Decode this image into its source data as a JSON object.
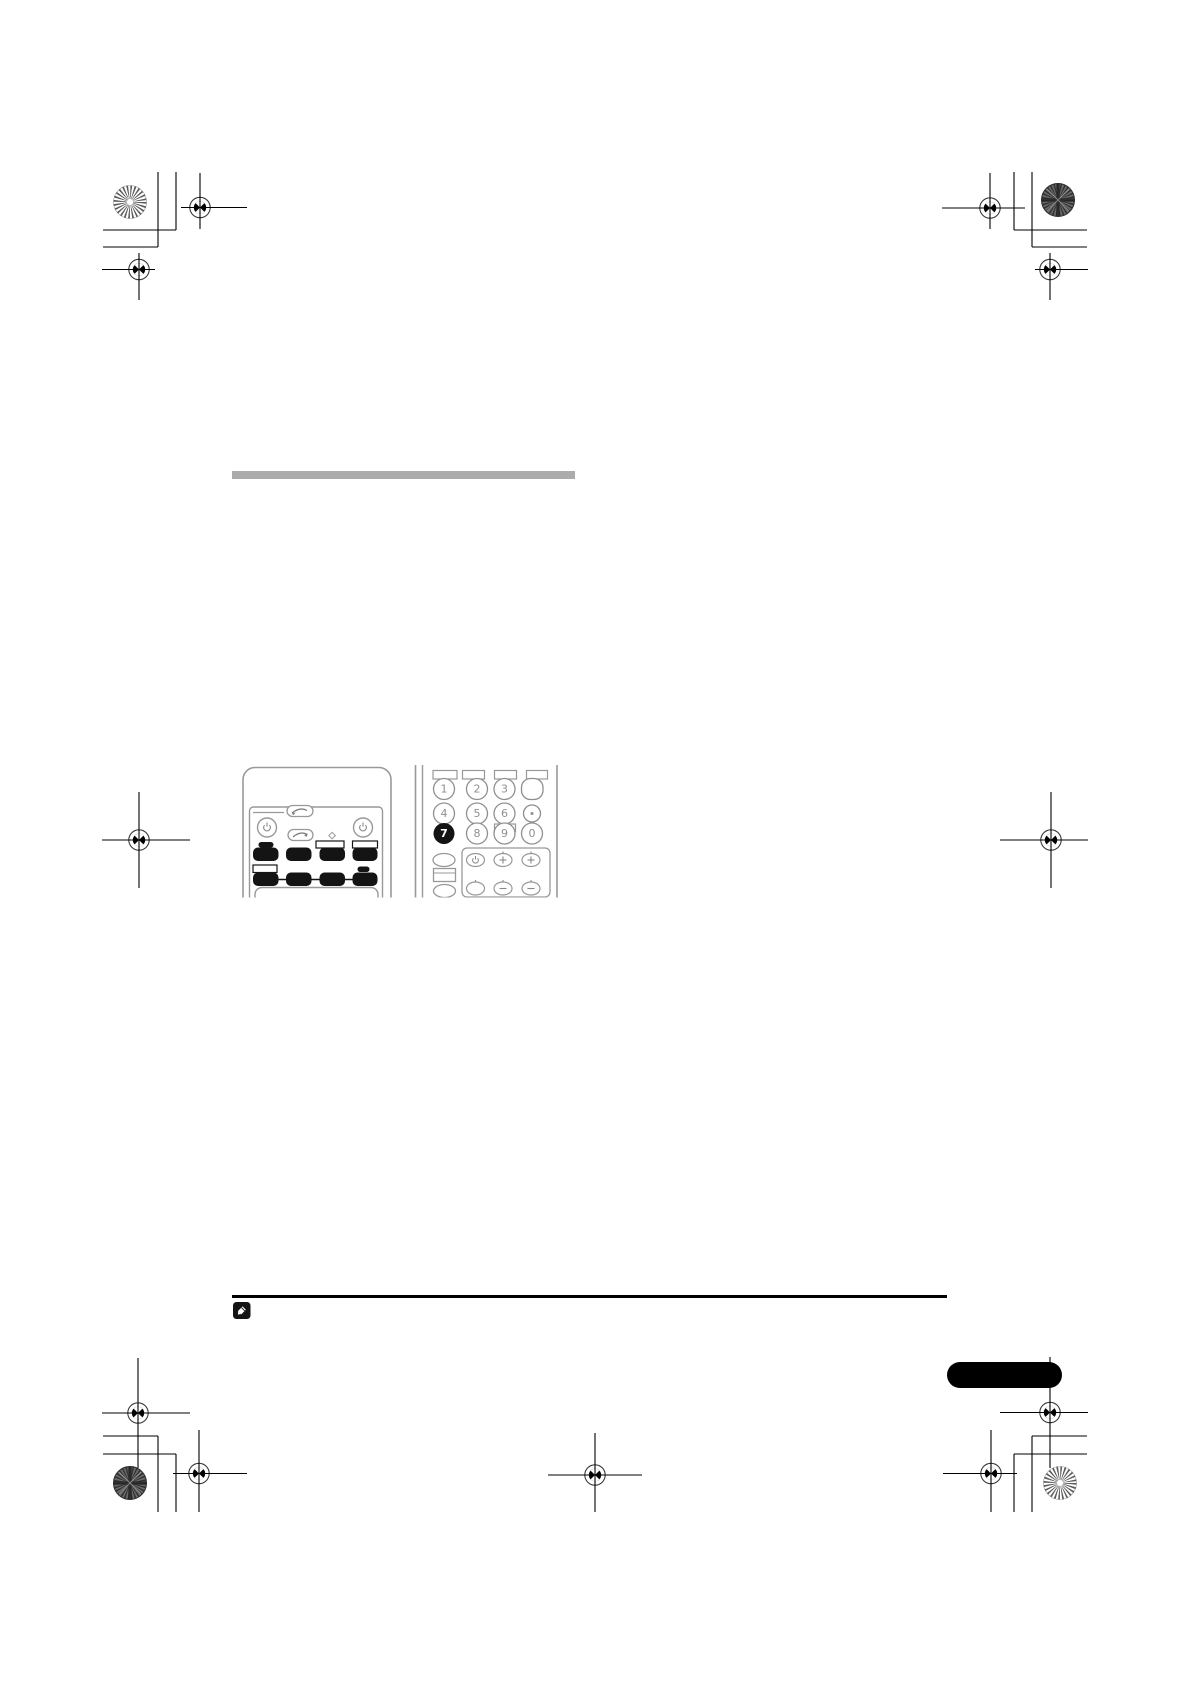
{
  "document": {
    "kind": "manual page print proof",
    "content_note": "page body is blank except heading placeholder bar, remote illustration, note rule and page tab"
  },
  "heading_bar": {
    "color": "#ababab"
  },
  "figure": {
    "keypad": {
      "digits": [
        "1",
        "2",
        "3",
        "4",
        "5",
        "6",
        "7",
        "8",
        "9",
        "0"
      ],
      "highlighted_digit": "7"
    }
  },
  "colors": {
    "ink": "#000000",
    "illustration_outline": "#999999",
    "button_fill": "#141414",
    "bar_gray": "#ababab",
    "tab_black": "#000000"
  },
  "icons": {
    "note": "pencil-note-icon",
    "power": "power-icon",
    "plus": "plus-icon",
    "minus": "minus-icon",
    "dot": "dot-icon",
    "flip_arrow": "curved-arrow-icon",
    "registration": "registration-target",
    "starburst": "starburst-mark"
  }
}
